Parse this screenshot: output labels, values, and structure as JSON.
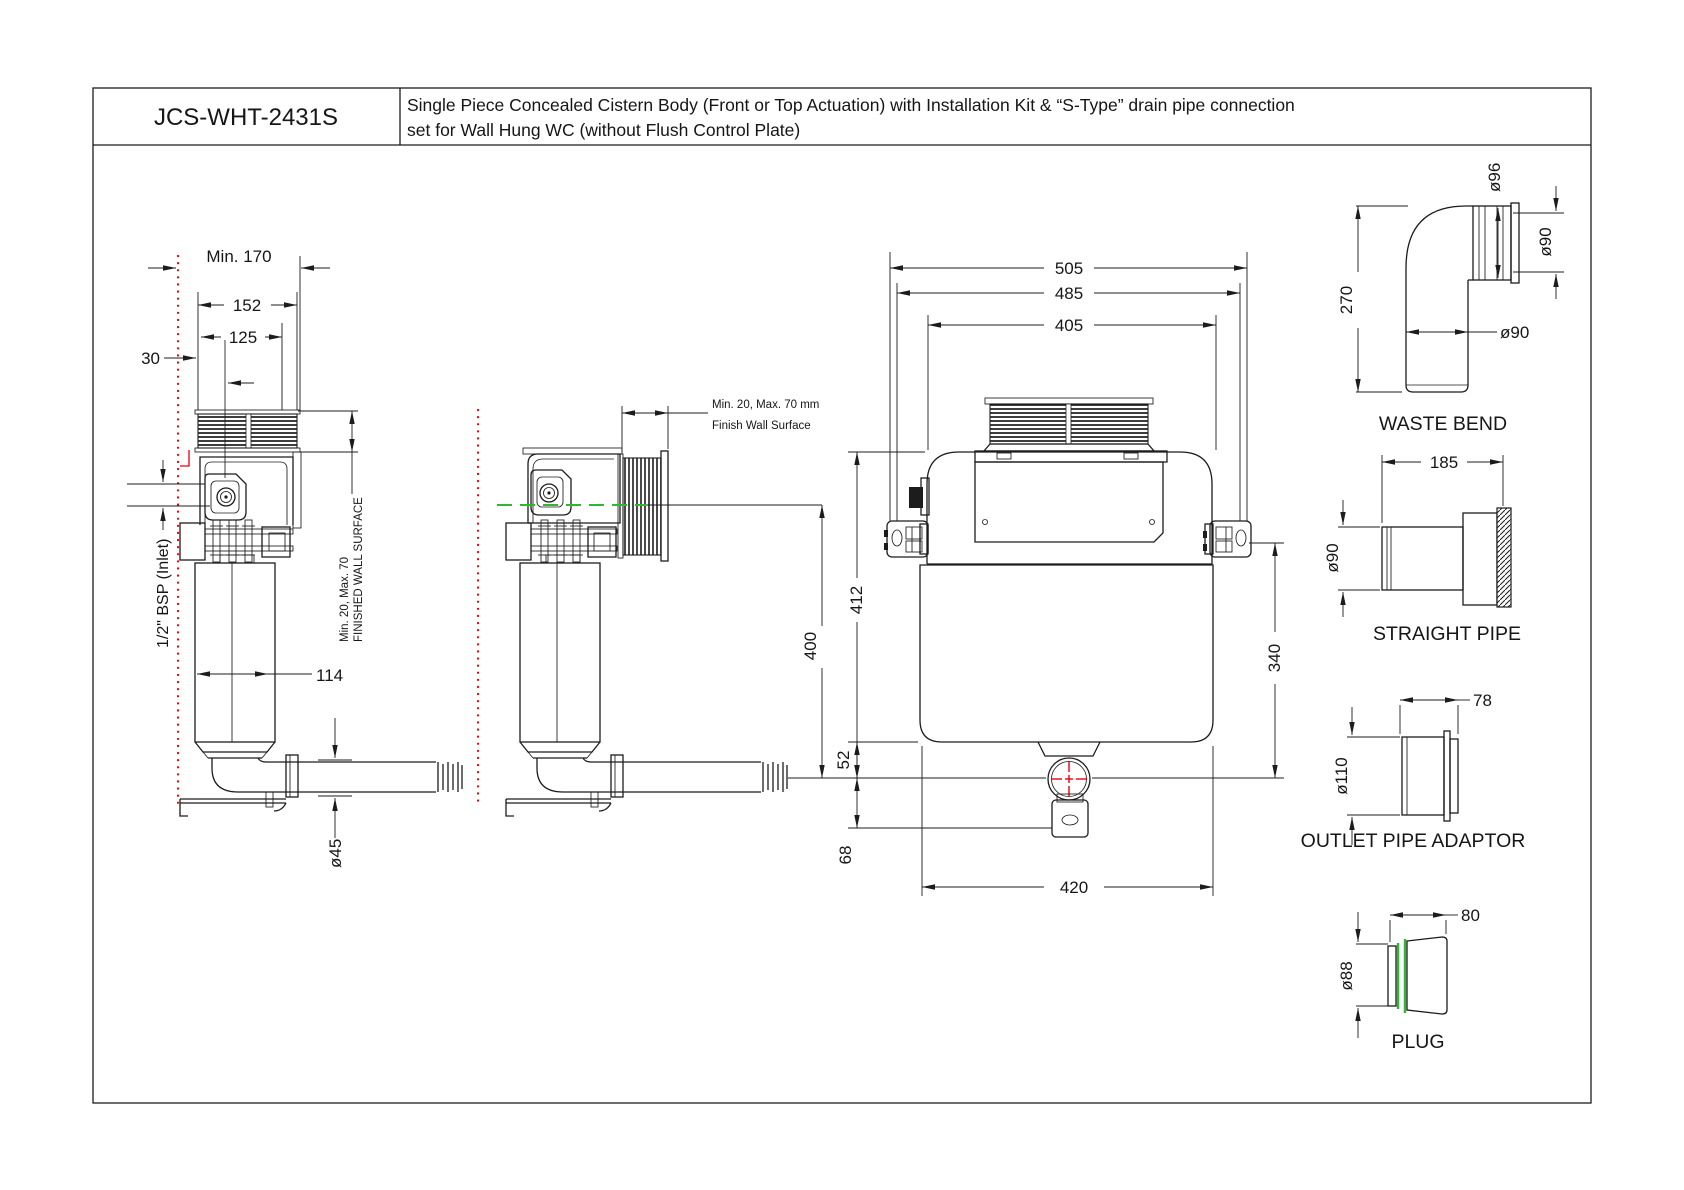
{
  "title_block": {
    "model": "JCS-WHT-2431S",
    "description_line1": "Single Piece Concealed Cistern Body (Front or Top Actuation) with Installation Kit &  “S-Type” drain pipe connection",
    "description_line2": "set for Wall Hung WC (without Flush Control Plate)"
  },
  "side_view": {
    "dim_min_depth": "Min. 170",
    "dim_frame_width": "152",
    "dim_inner_width": "125",
    "dim_offset": "30",
    "dim_tank_width": "114",
    "dim_pipe_dia": "ø45",
    "inlet_label": "1/2\" BSP (Inlet)",
    "wall_note_1": "Min. 20, Max. 70",
    "wall_note_2": "FINISHED WALL SURFACE"
  },
  "installed_view": {
    "wall_note_1": "Min. 20, Max. 70 mm",
    "wall_note_2": "Finish Wall Surface",
    "dim_height": "400"
  },
  "front_view": {
    "dim_overall_width": "505",
    "dim_bracket_width": "485",
    "dim_body_width": "405",
    "dim_height": "412",
    "dim_bracket_height": "340",
    "dim_outlet_drop": "52",
    "dim_bracket_drop": "68",
    "dim_tank_width": "420"
  },
  "parts": {
    "waste_bend": {
      "label": "WASTE BEND",
      "dim_height": "270",
      "dim_socket_od": "ø96",
      "dim_socket_id": "ø90",
      "dim_pipe_od": "ø90"
    },
    "straight_pipe": {
      "label": "STRAIGHT PIPE",
      "dim_length": "185",
      "dim_dia": "ø90"
    },
    "outlet_adaptor": {
      "label": "OUTLET PIPE ADAPTOR",
      "dim_length": "78",
      "dim_dia": "ø110"
    },
    "plug": {
      "label": "PLUG",
      "dim_length": "80",
      "dim_dia": "ø88"
    }
  },
  "colors": {
    "line": "#1c1c1c",
    "red": "#e8000d",
    "green": "#2eb82e"
  }
}
